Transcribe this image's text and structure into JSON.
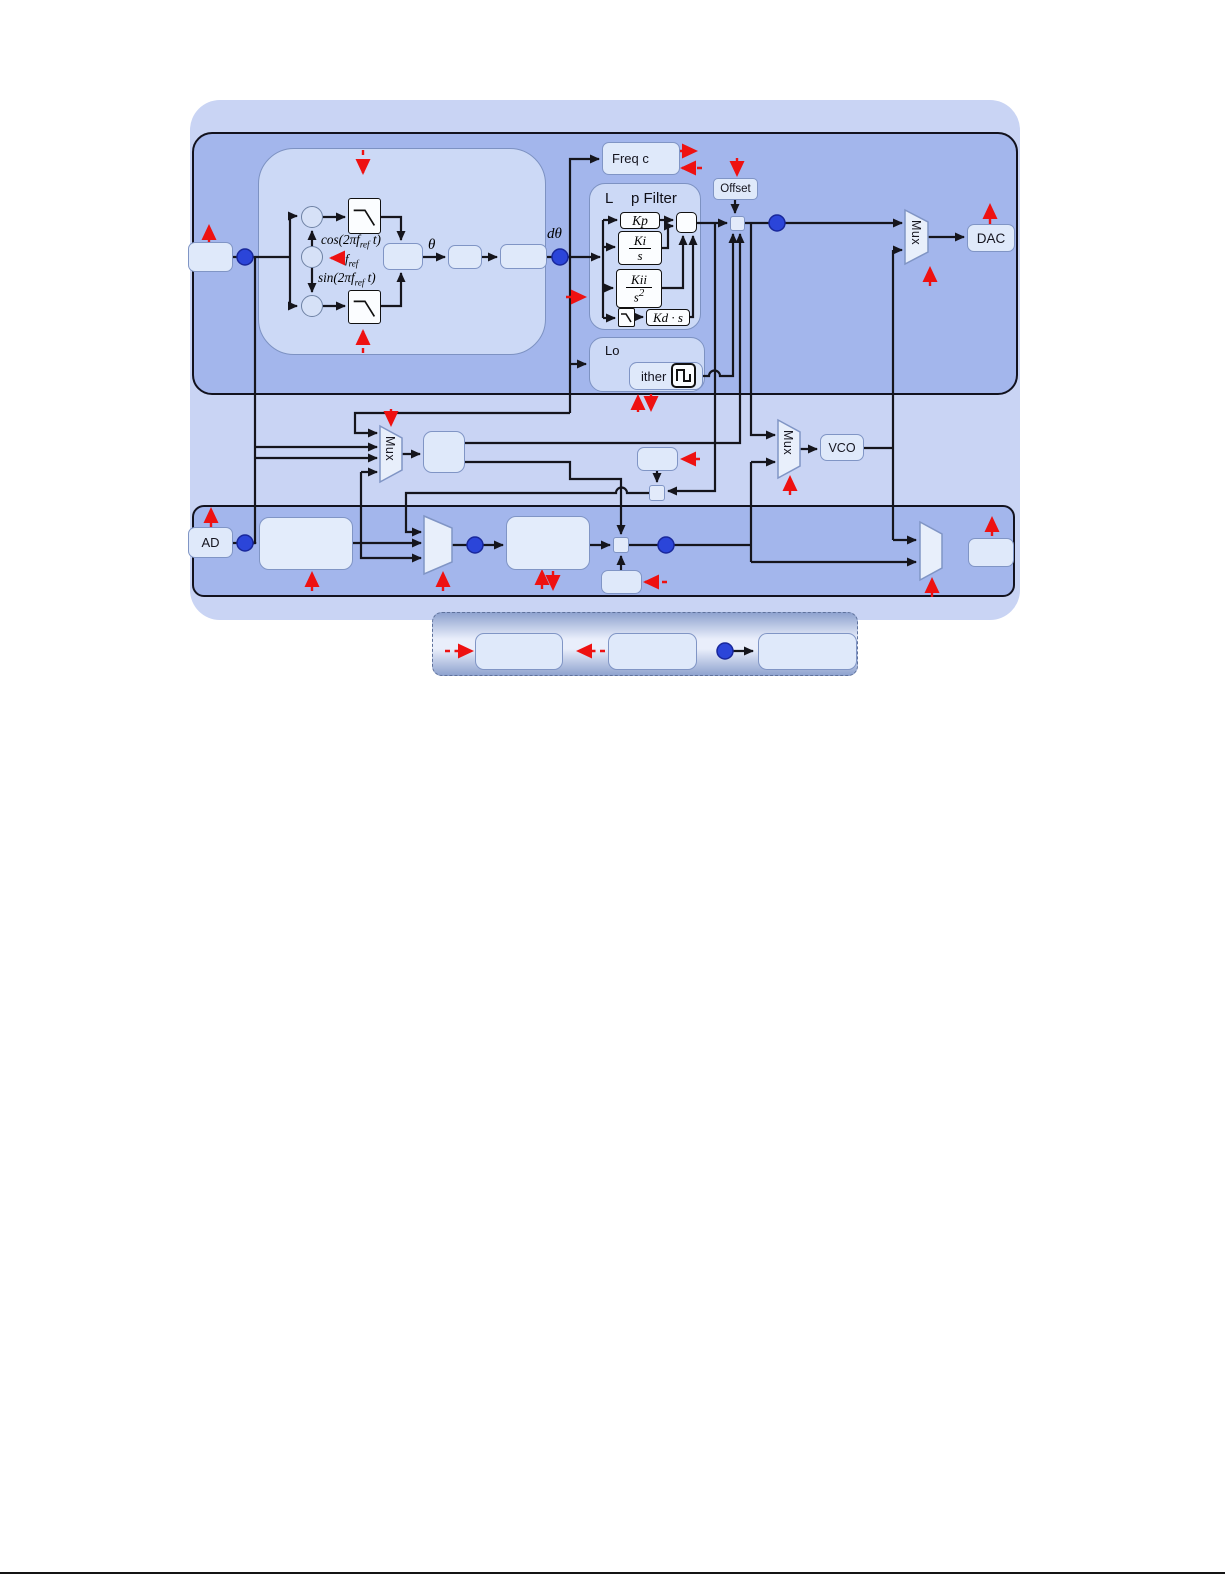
{
  "labels": {
    "mux": "Mux",
    "dac": "DAC",
    "vco": "VCO",
    "adc": "AD",
    "freq_counter": "Freq c",
    "offset": "Offset",
    "lo_title": "Lo",
    "dither": "ither",
    "lf_title_l": "L",
    "lf_title_rest": "p Filter",
    "kp": "Kp",
    "ki_num": "Ki",
    "ki_den": "s",
    "kii_num": "Kii",
    "kii_den": "s",
    "kii_exp": "2",
    "kd": "Kd · s",
    "theta": "θ",
    "dtheta": "dθ",
    "cos_pre": "cos(2π",
    "sin_pre": "sin(2π",
    "fvar": "f",
    "fsub": "ref",
    "trig_post": " t)"
  },
  "colors": {
    "signal_node_blue": "#2b45d9",
    "config_arrow_red": "#ee1111",
    "band_fill": "#a3b6ec",
    "outer_fill": "#c9d4f4",
    "panel_fill": "#ccd9f6"
  }
}
